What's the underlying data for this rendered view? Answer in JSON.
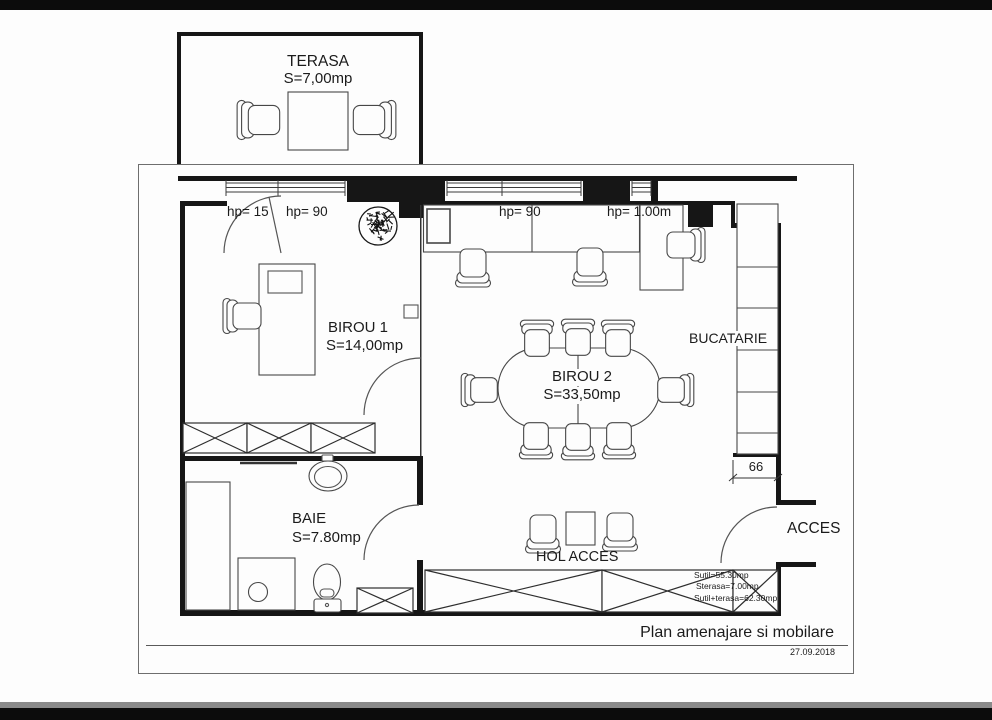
{
  "rooms": {
    "terasa": {
      "name": "TERASA",
      "area": "S=7,00mp"
    },
    "birou1": {
      "name": "BIROU 1",
      "area": "S=14,00mp"
    },
    "birou2": {
      "name": "BIROU 2",
      "area": "S=33,50mp"
    },
    "bucatarie": {
      "name": "BUCATARIE"
    },
    "baie": {
      "name": "BAIE",
      "area": "S=7.80mp"
    },
    "hol": {
      "name": "HOL ACCES"
    },
    "acces": {
      "name": "ACCES"
    }
  },
  "dims": {
    "hp_terasa_door": "hp= 15",
    "hp_birou1_window": "hp= 90",
    "hp_birou2_left": "hp= 90",
    "hp_birou2_right": "hp= 1.00m",
    "counter_width": "66"
  },
  "summary": {
    "util": "Sutil=55.30mp",
    "terasa": "Sterasa=7.00mp",
    "total": "Sutil+terasa=62.30mp"
  },
  "title_block": {
    "title": "Plan amenajare si mobilare",
    "date": "27.09.2018"
  },
  "colors": {
    "wall": "#161616",
    "furniture_line": "#474747",
    "text": "#1b1b1b",
    "paper": "#fdfdfd"
  }
}
